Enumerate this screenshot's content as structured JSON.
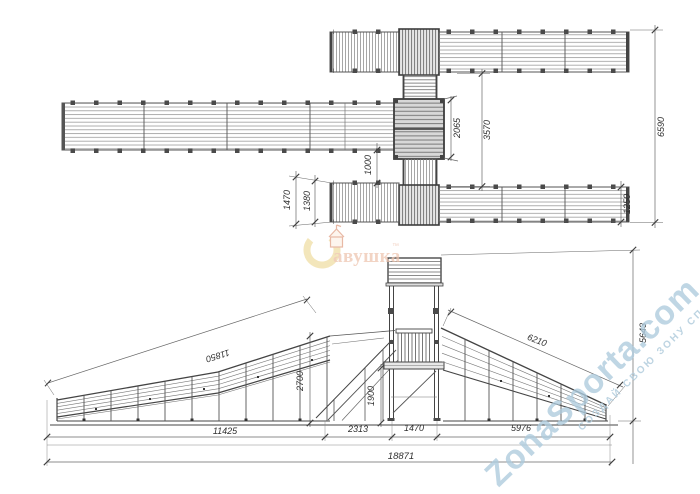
{
  "plan": {
    "d2065": "2065",
    "d3570": "3570",
    "d1000": "1000",
    "d6590": "6590",
    "d1250": "1250",
    "d1470": "1470",
    "d1380": "1380"
  },
  "elevation": {
    "d11850": "11850",
    "d11425": "11425",
    "d2313": "2313",
    "d1470": "1470",
    "d5976": "5976",
    "d18871": "18871",
    "d2700": "2700",
    "d1900": "1900",
    "d6210": "6210",
    "d5643": "5643"
  },
  "watermarks": {
    "brand": "авушка",
    "brand_tm": "™",
    "site": "ZonaSporta.com",
    "tagline": "СОЗДАЙ СВОЮ ЗОНУ СПОРТА"
  }
}
